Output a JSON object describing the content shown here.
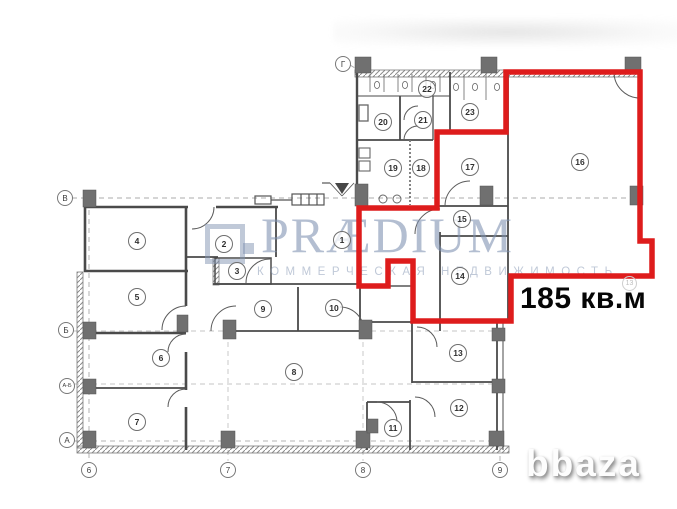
{
  "area_label": {
    "text": "185 кв.м"
  },
  "watermark": {
    "brand": "PRÆDIUM",
    "subtitle": "КОММЕРЧЕСКАЯ НЕДВИЖИМОСТЬ",
    "site": "bbaza"
  },
  "plan": {
    "room_numbers": [
      "1",
      "2",
      "3",
      "4",
      "5",
      "6",
      "7",
      "8",
      "9",
      "10",
      "11",
      "12",
      "13",
      "14",
      "15",
      "16",
      "17",
      "18",
      "19",
      "20",
      "21",
      "22",
      "23"
    ],
    "row_axis_labels": [
      "Г",
      "В",
      "Б",
      "А-Б",
      "А"
    ],
    "col_axis_labels": [
      "6",
      "7",
      "8",
      "9"
    ],
    "faint_label": "13"
  },
  "colors": {
    "highlight_red": "#de1c1c",
    "wall_gray": "#4a4a4a",
    "watermark_blue": "#8396b4"
  }
}
